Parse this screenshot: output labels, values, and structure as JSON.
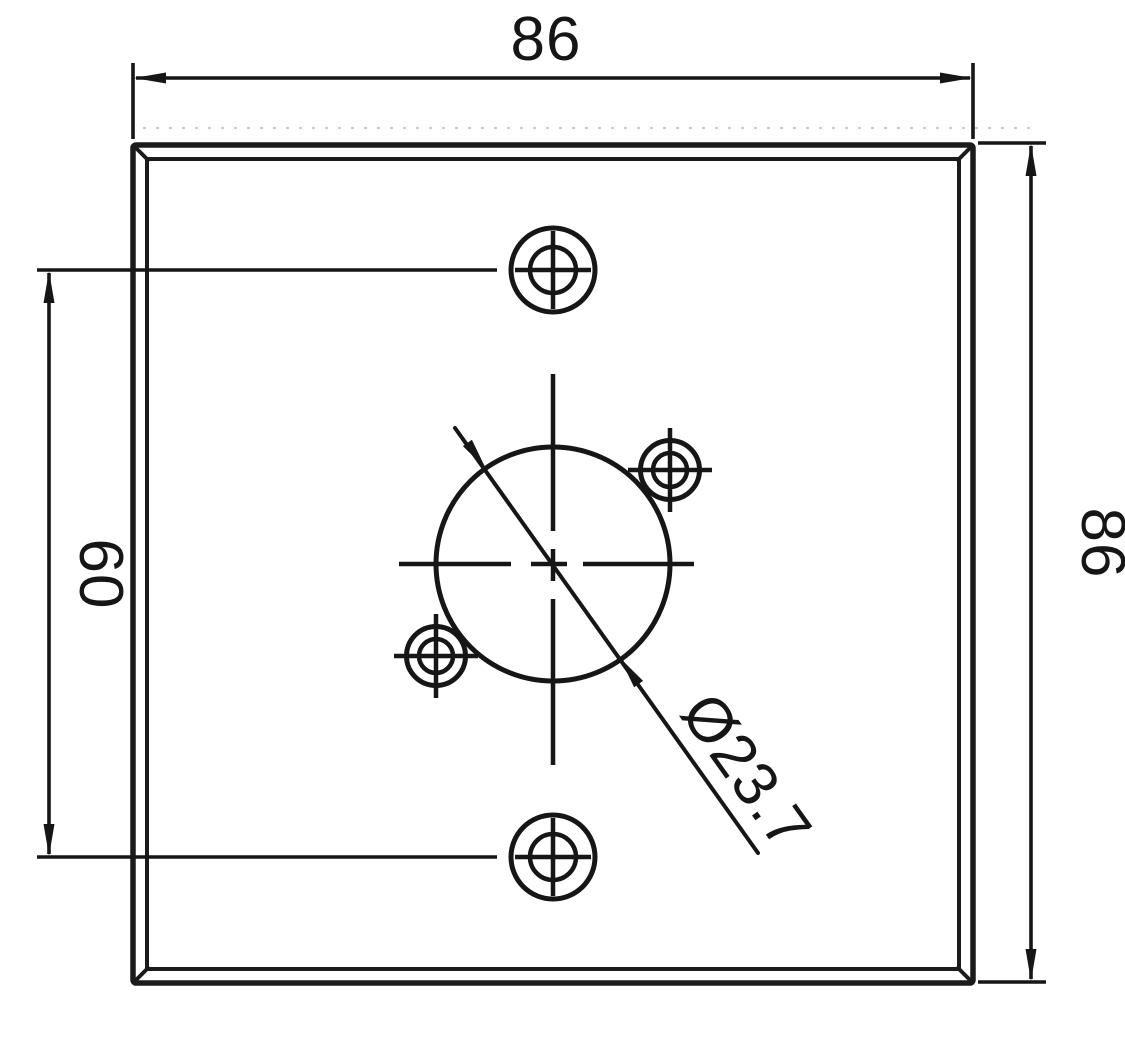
{
  "drawing": {
    "type": "technical-dimension-drawing",
    "subject": "square connector mounting plate, front view"
  },
  "colors": {
    "line": "#161616",
    "background": "#ffffff",
    "crease_line": "#c8c8c8"
  },
  "dimensions": {
    "top_width": {
      "label": "86"
    },
    "right_height": {
      "label": "86"
    },
    "left_hole_spacing": {
      "label": "60"
    },
    "center_hole_diameter": {
      "label": "Ø23.7"
    }
  }
}
